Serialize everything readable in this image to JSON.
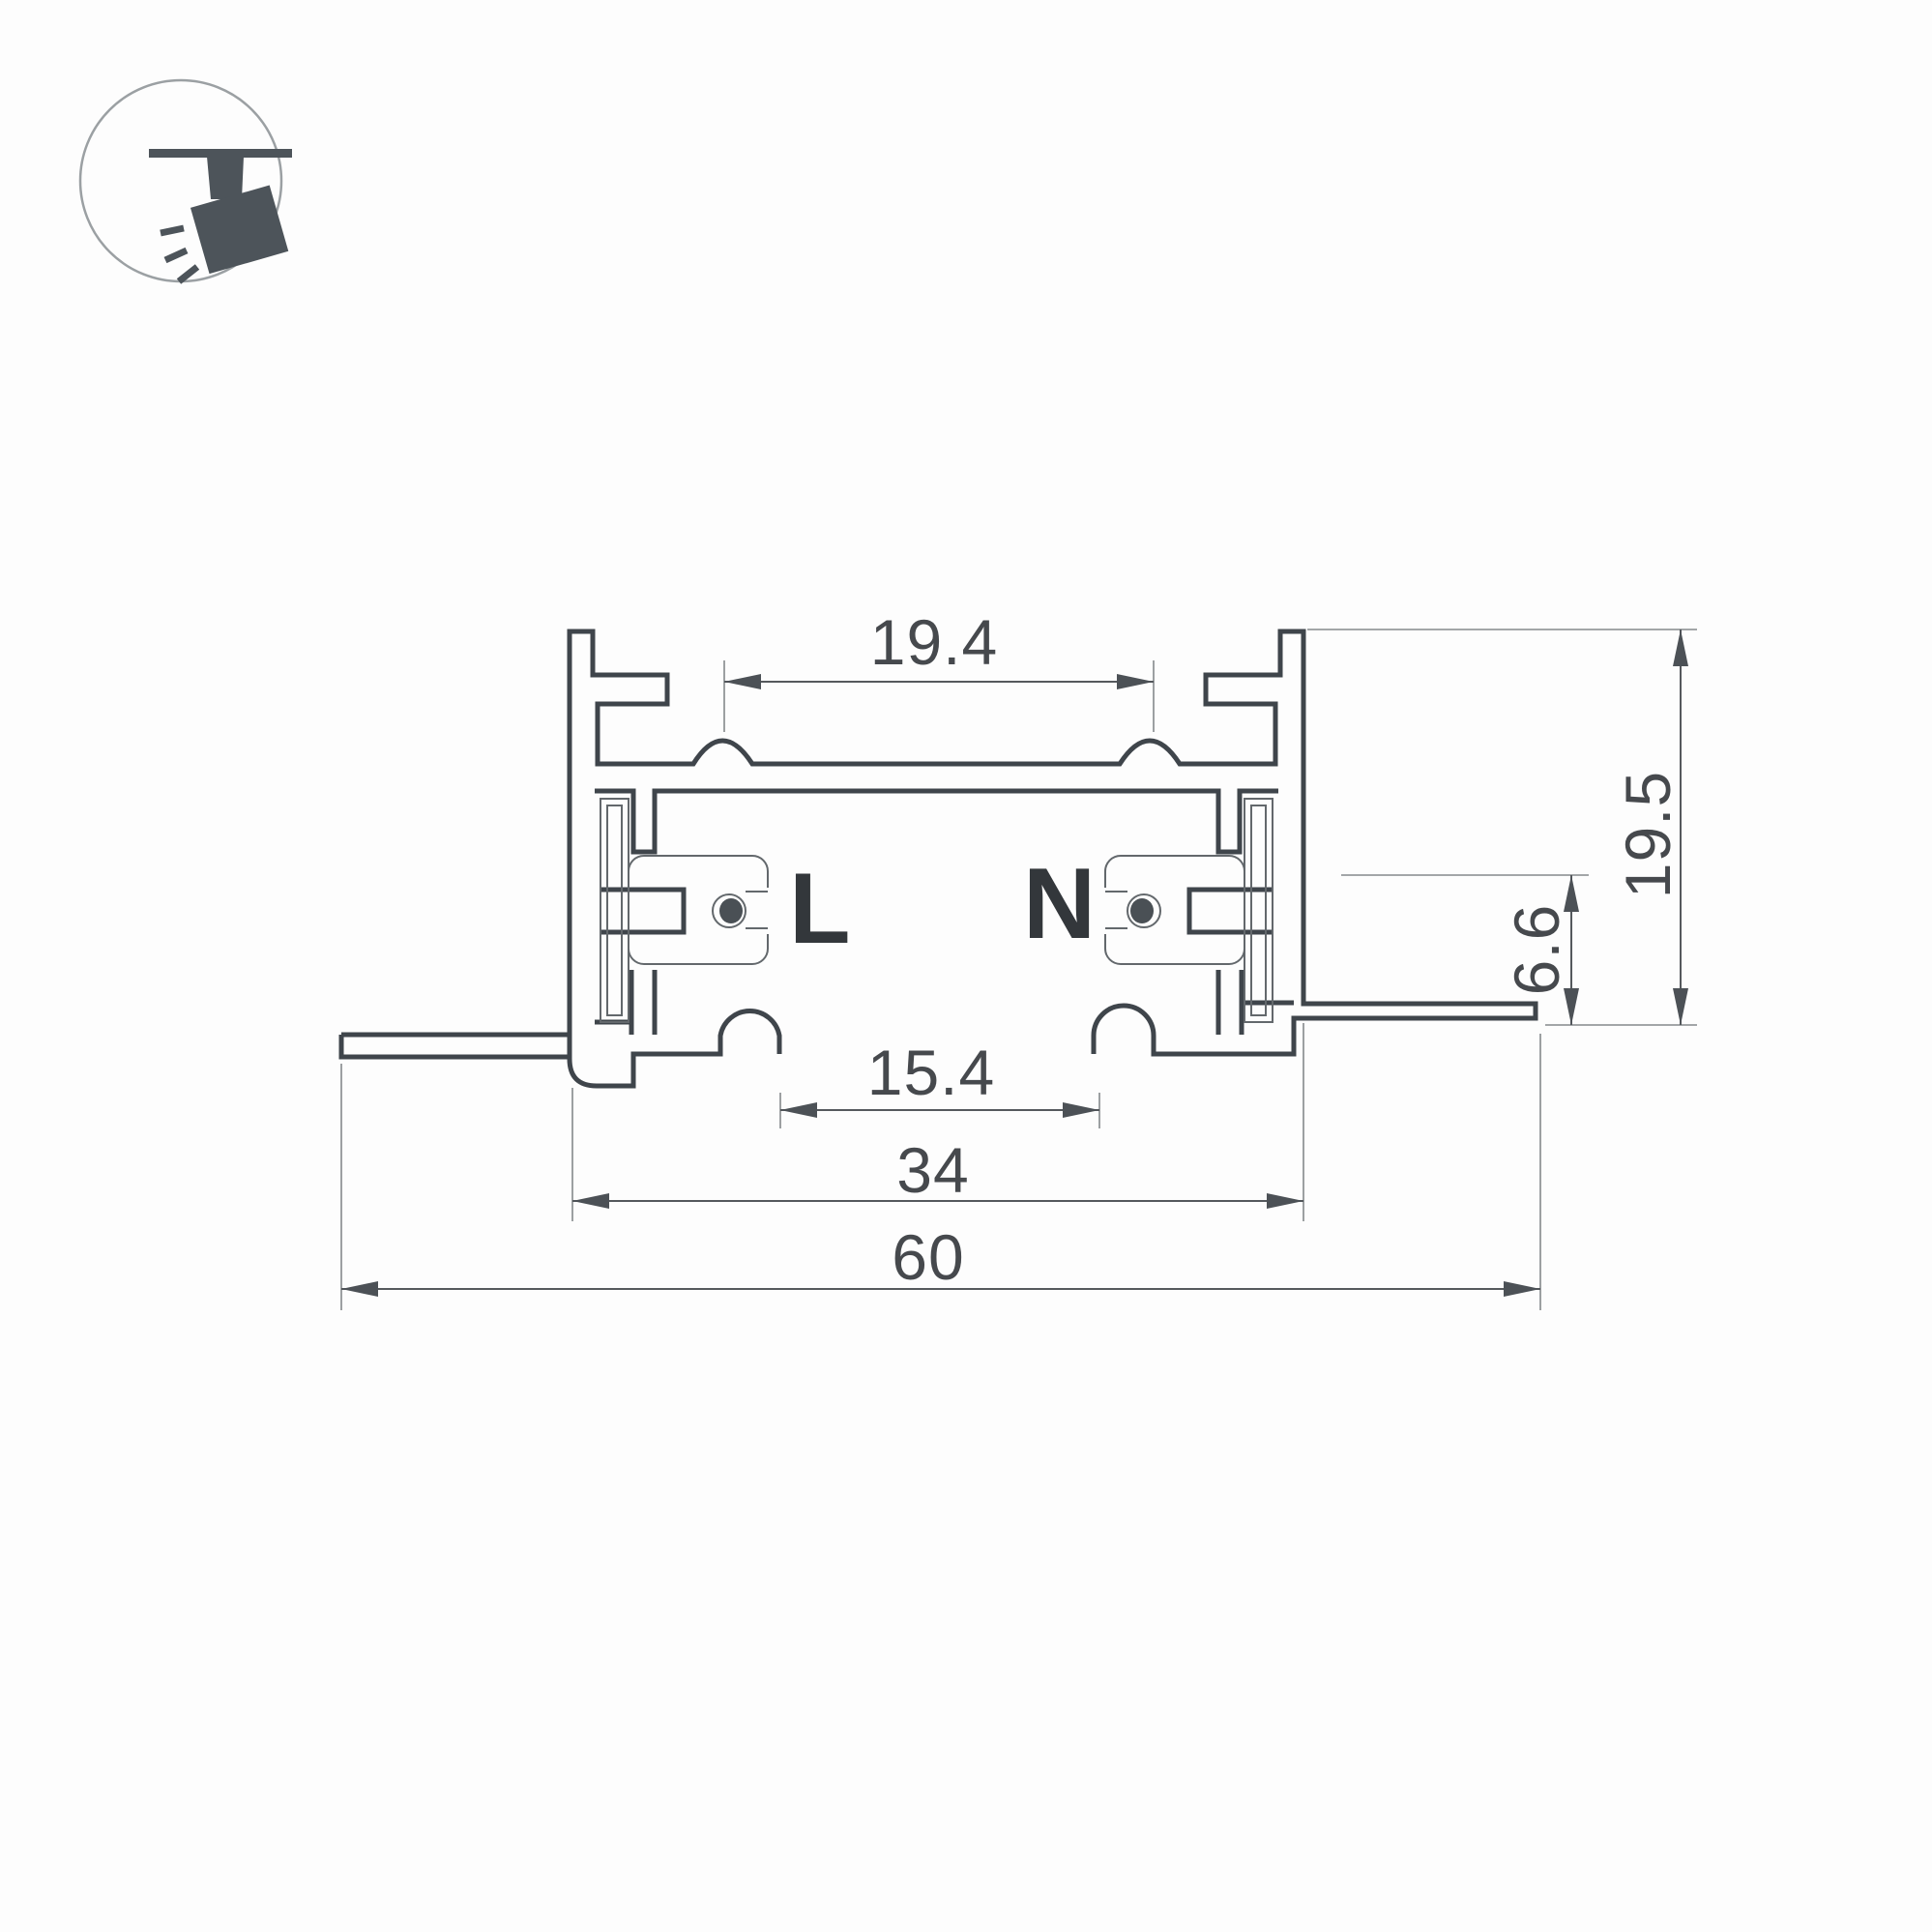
{
  "drawing": {
    "type": "technical-cross-section",
    "subject": "recessed-track-busbar-profile",
    "dimensions": {
      "top_slot_width": "19.4",
      "overall_height": "19.5",
      "conductor_height": "6.6",
      "bottom_opening_width": "15.4",
      "body_width": "34",
      "overall_width": "60"
    },
    "conductors": {
      "live": "L",
      "neutral": "N"
    }
  },
  "icon": {
    "name": "track-spotlight",
    "description": "ceiling track with tilted spotlight head and light rays"
  },
  "colors": {
    "background": "#fdfdfd",
    "profile_outline": "#3f454b",
    "profile_thin_line": "#63686c",
    "dimension_line": "#55595d",
    "extension_line": "#85898c",
    "dimension_text": "#46494d",
    "conductor_label": "#33373b",
    "conductor_dot": "#4a5055",
    "icon_glyph": "#4d545a",
    "icon_circle_outline": "#9ba0a3"
  }
}
